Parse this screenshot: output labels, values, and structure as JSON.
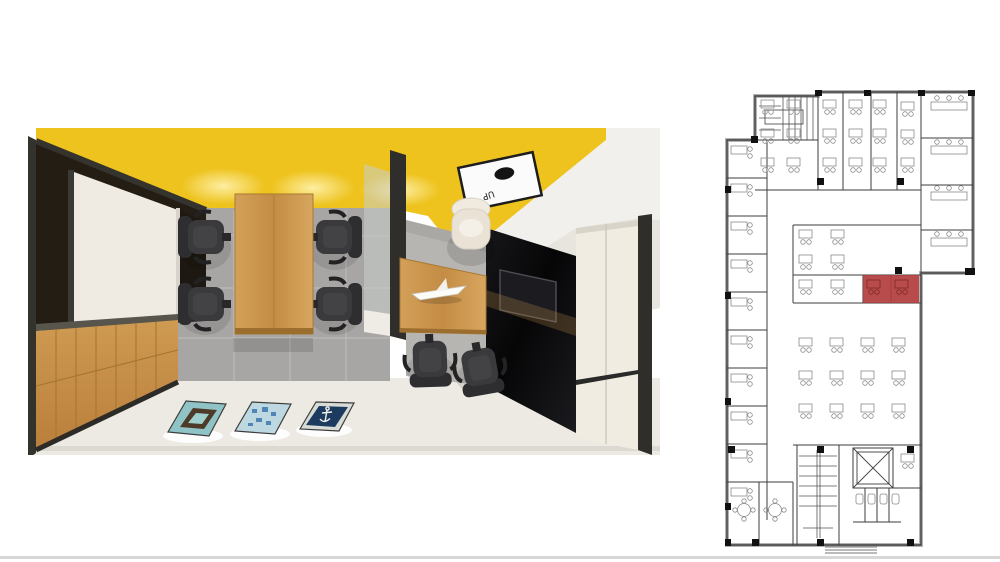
{
  "page": {
    "background_color": "#ffffff",
    "bottom_divider_color": "#d8d8d8"
  },
  "render": {
    "label": "office-interior-3d-render",
    "ceiling_color": "#eec31e",
    "ceiling_sign": {
      "label": "UP",
      "panel_color": "#fbfbfb",
      "dot_color": "#141414"
    },
    "materials": {
      "wood": "#c austria",
      "wood_table": "#c8924c",
      "tile_floor": "#a7a6a4",
      "concrete_floor": "#b7b5b1",
      "light_floor": "#edeae3",
      "dark_frame": "#34332e",
      "white_panel": "#efeae2",
      "black_glass": "#0c0c0e",
      "cabinet_cream": "#f1ece2"
    },
    "furniture_counts": {
      "meeting_chairs": 4,
      "guest_chairs": 2,
      "executive_chairs": 1,
      "floor_posters": 3
    },
    "poster_colors": [
      "#8fc3c6",
      "#bdd8e0",
      "#1d3a5f"
    ]
  },
  "floorplan": {
    "label": "building-floor-plan",
    "wall_color": "#3e3e3e",
    "window_band_color": "#b3b3b3",
    "detail_color": "#8a8a8a",
    "highlight_color": "#b23c3c",
    "highlight_detail_color": "#7e2727"
  }
}
